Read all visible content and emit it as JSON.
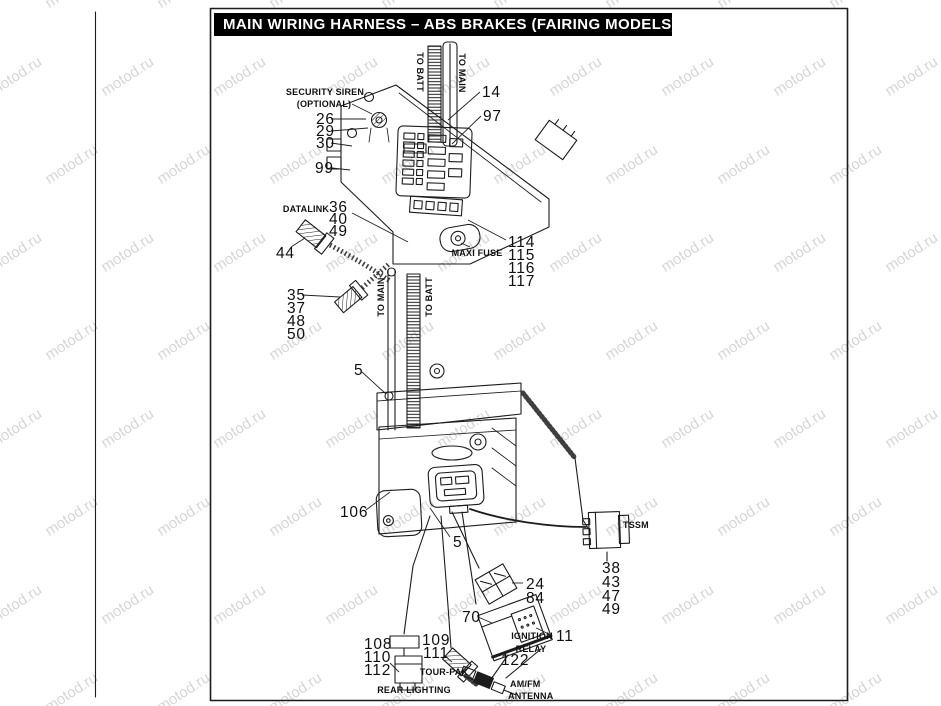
{
  "title": "MAIN WIRING  HARNESS – ABS BRAKES (FAIRING MODELS)",
  "colors": {
    "title_bg": "#000000",
    "title_fg": "#ffffff",
    "line": "#1c1c1c",
    "watermark": "rgba(115,115,115,0.30)"
  },
  "watermark": {
    "text": "motod.ru",
    "rotation_deg": -33,
    "col_step": 112,
    "row_step": 88,
    "stagger": 56
  },
  "labels": [
    {
      "text": "SECURITY SIREN",
      "x": 325,
      "y": 87,
      "anchor": "center"
    },
    {
      "text": "(OPTIONAL)",
      "x": 324,
      "y": 99,
      "anchor": "center"
    },
    {
      "text": "DATALINK",
      "x": 306,
      "y": 204,
      "anchor": "center"
    },
    {
      "text": "MAXI FUSE",
      "x": 477,
      "y": 248,
      "anchor": "center"
    },
    {
      "text": "TO BATT",
      "x": 420,
      "y": 72,
      "rot": 90
    },
    {
      "text": "TO MAIN",
      "x": 462,
      "y": 73,
      "rot": 90
    },
    {
      "text": "TO MAIN",
      "x": 381,
      "y": 297,
      "rot": -90
    },
    {
      "text": "TO BATT",
      "x": 429,
      "y": 297,
      "rot": -90
    },
    {
      "text": "TSSM",
      "x": 623,
      "y": 520
    },
    {
      "text": "IGNITION",
      "x": 532,
      "y": 631,
      "anchor": "center"
    },
    {
      "text": "RELAY",
      "x": 531,
      "y": 644,
      "anchor": "center"
    },
    {
      "text": "TOUR-PAK",
      "x": 444,
      "y": 667,
      "anchor": "center"
    },
    {
      "text": "REAR LIGHTING",
      "x": 414,
      "y": 685,
      "anchor": "center"
    },
    {
      "text": "AM/FM",
      "x": 510,
      "y": 679
    },
    {
      "text": "ANTENNA",
      "x": 508,
      "y": 691
    }
  ],
  "callouts": [
    {
      "num": "14",
      "x": 482,
      "y": 84
    },
    {
      "num": "97",
      "x": 483,
      "y": 108
    },
    {
      "num": "26",
      "x": 316,
      "y": 111
    },
    {
      "num": "29",
      "x": 316,
      "y": 123
    },
    {
      "num": "30",
      "x": 316,
      "y": 135
    },
    {
      "num": "99",
      "x": 315,
      "y": 160
    },
    {
      "num": "36",
      "x": 329,
      "y": 199
    },
    {
      "num": "40",
      "x": 329,
      "y": 211
    },
    {
      "num": "49",
      "x": 329,
      "y": 223
    },
    {
      "num": "44",
      "x": 276,
      "y": 245
    },
    {
      "num": "35",
      "x": 287,
      "y": 287
    },
    {
      "num": "37",
      "x": 287,
      "y": 300
    },
    {
      "num": "48",
      "x": 287,
      "y": 313
    },
    {
      "num": "50",
      "x": 287,
      "y": 326
    },
    {
      "num": "114",
      "x": 508,
      "y": 234
    },
    {
      "num": "115",
      "x": 508,
      "y": 247
    },
    {
      "num": "116",
      "x": 508,
      "y": 260
    },
    {
      "num": "117",
      "x": 508,
      "y": 273
    },
    {
      "num": "5",
      "x": 354,
      "y": 362
    },
    {
      "num": "106",
      "x": 340,
      "y": 504
    },
    {
      "num": "5",
      "x": 453,
      "y": 534
    },
    {
      "num": "38",
      "x": 602,
      "y": 560
    },
    {
      "num": "43",
      "x": 602,
      "y": 574
    },
    {
      "num": "47",
      "x": 602,
      "y": 588
    },
    {
      "num": "49",
      "x": 602,
      "y": 601
    },
    {
      "num": "24",
      "x": 526,
      "y": 576
    },
    {
      "num": "84",
      "x": 526,
      "y": 590
    },
    {
      "num": "70",
      "x": 462,
      "y": 609
    },
    {
      "num": "11",
      "x": 556,
      "y": 628
    },
    {
      "num": "122",
      "x": 501,
      "y": 652
    },
    {
      "num": "108",
      "x": 364,
      "y": 636
    },
    {
      "num": "110",
      "x": 364,
      "y": 649
    },
    {
      "num": "112",
      "x": 364,
      "y": 662
    },
    {
      "num": "109",
      "x": 422,
      "y": 632
    },
    {
      "num": "111",
      "x": 423,
      "y": 645
    }
  ]
}
